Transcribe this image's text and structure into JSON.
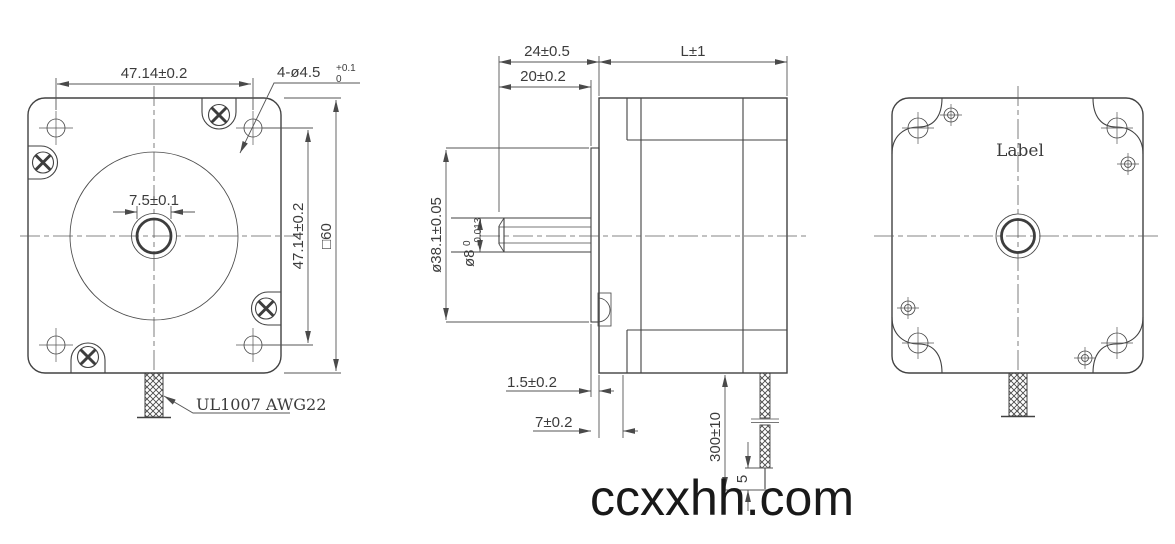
{
  "front_view": {
    "dim_hole_spacing_h": "47.14±0.2",
    "hole_callout": {
      "base": "4-ø4.5",
      "tol_upper": "+0.1",
      "tol_lower": "0"
    },
    "dim_shaft_flat": "7.5±0.1",
    "dim_hole_spacing_v": "47.14±0.2",
    "dim_frame_size": "□60",
    "wire_spec": "UL1007 AWG22"
  },
  "side_view": {
    "dim_shaft_extension": "24±0.5",
    "dim_shaft_length": "20±0.2",
    "dim_body_length": "L±1",
    "dim_boss_diameter": "ø38.1±0.05",
    "shaft_diameter": {
      "base": "ø8",
      "tol_upper": "0",
      "tol_lower": "-0.013"
    },
    "dim_boss_height": "1.5±0.2",
    "dim_front_depth": "7±0.2",
    "dim_wire_length": "300±10",
    "dim_strip_length": "5"
  },
  "back_view": {
    "label_text": "Label"
  },
  "watermark": "ccxxhh.com",
  "colors": {
    "line": "#424242",
    "watermark": "#191919",
    "background": "#ffffff"
  }
}
